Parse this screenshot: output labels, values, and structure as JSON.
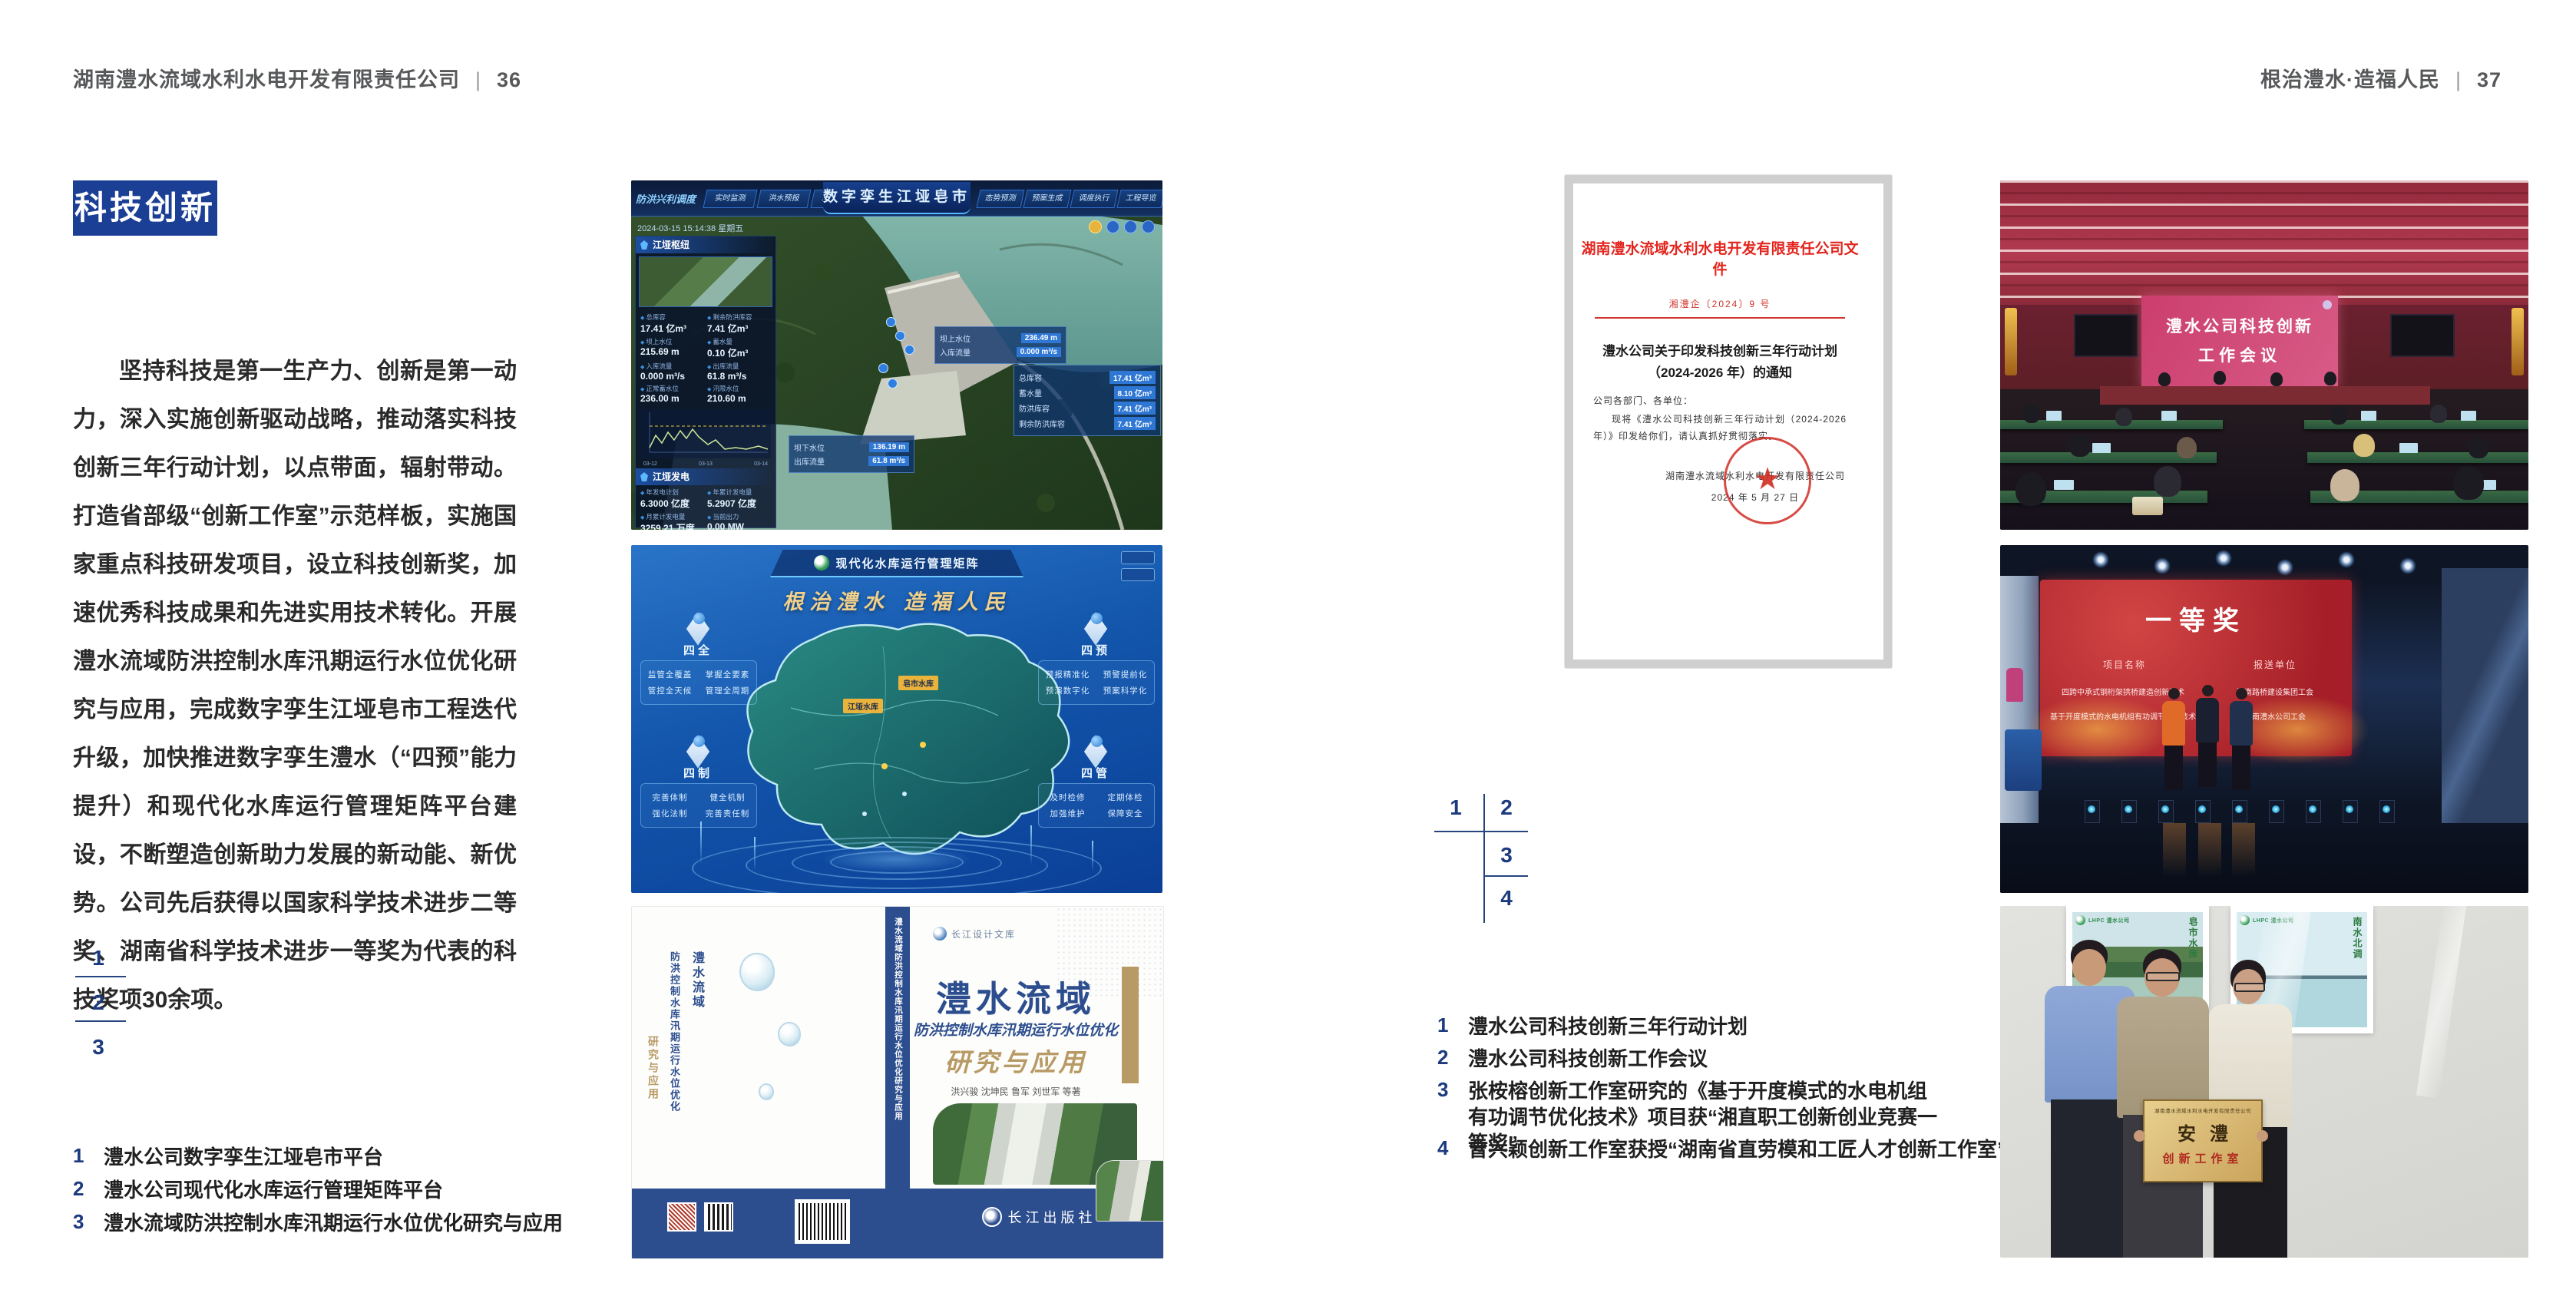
{
  "header_left": {
    "company": "湖南澧水流域水利水电开发有限责任公司",
    "sep": "|",
    "page": "36"
  },
  "header_right": {
    "slogan": "根治澧水·造福人民",
    "sep": "|",
    "page": "37"
  },
  "colors": {
    "accent_blue": "#1c3f96",
    "index_blue": "#1c3a7e",
    "doc_red": "#d0342c",
    "screen_pink": "#cb3e6e",
    "award_red": "#a61f28",
    "plaque_gold": "#caa45c"
  },
  "left_page": {
    "badge": "科技创新",
    "paragraph": "坚持科技是第一生产力、创新是第一动力，深入实施创新驱动战略，推动落实科技创新三年行动计划，以点带面，辐射带动。打造省部级“创新工作室”示范样板，实施国家重点科技研发项目，设立科技创新奖，加速优秀科技成果和先进实用技术转化。开展澧水流域防洪控制水库汛期运行水位优化研究与应用，完成数字孪生江垭皂市工程迭代升级，加快推进数字孪生澧水（“四预”能力提升）和现代化水库运行管理矩阵平台建设，不断塑造创新助力发展的新动能、新优势。公司先后获得以国家科学技术进步二等奖、湖南省科学技术进步一等奖为代表的科技奖项30余项。",
    "figure_index": {
      "n1": "1",
      "n2": "2",
      "n3": "3"
    },
    "captions": [
      {
        "num": "1",
        "text": "澧水公司数字孪生江垭皂市平台"
      },
      {
        "num": "2",
        "text": "澧水公司现代化水库运行管理矩阵平台"
      },
      {
        "num": "3",
        "text": "澧水流域防洪控制水库汛期运行水位优化研究与应用"
      }
    ]
  },
  "right_page": {
    "figure_index": {
      "n1": "1",
      "n2": "2",
      "n3": "3",
      "n4": "4"
    },
    "captions": [
      {
        "num": "1",
        "text": "澧水公司科技创新三年行动计划"
      },
      {
        "num": "2",
        "text": "澧水公司科技创新工作会议"
      },
      {
        "num": "3",
        "text": "张桉榕创新工作室研究的《基于开度模式的水电机组有功调节优化技术》项目获“湘直职工创新创业竞赛一等奖”"
      },
      {
        "num": "4",
        "text": "曾兴颖创新工作室获授“湖南省直劳模和工匠人才创新工作室”"
      }
    ]
  },
  "fig_twin": {
    "title": "数字孪生江垭皂市",
    "mode_label": "防洪兴利调度",
    "tabs_left": [
      "实时监测",
      "洪水预报",
      "防洪预警"
    ],
    "tabs_right": [
      "态势预测",
      "预案生成",
      "调度执行",
      "工程导览"
    ],
    "timestamp": "2024-03-15 15:14:38 星期五",
    "panel_hub": "江垭枢纽",
    "hub_stats": [
      [
        "总库容",
        "17.41 亿m³"
      ],
      [
        "剩余防洪库容",
        "7.41 亿m³"
      ],
      [
        "坝上水位",
        "215.69 m"
      ],
      [
        "蓄水量",
        "0.10 亿m³"
      ],
      [
        "入库流量",
        "0.000 m³/s"
      ],
      [
        "出库流量",
        "61.8 m³/s"
      ],
      [
        "正常蓄水位",
        "236.00 m"
      ],
      [
        "汛限水位",
        "210.60 m"
      ]
    ],
    "chart_xticks": [
      "03-12",
      "03-13",
      "03-14"
    ],
    "panel_gen": "江垭发电",
    "gen_stats": [
      [
        "年发电计划",
        "6.3000 亿度"
      ],
      [
        "年累计发电量",
        "5.2907 亿度"
      ],
      [
        "月累计发电量",
        "3259.21 万度"
      ],
      [
        "当前出力",
        "0.00 MW"
      ],
      [
        "发电流量",
        "0.00 m³/s"
      ],
      [
        "弃水流量",
        "0.00 m³/s"
      ]
    ],
    "callout_up": [
      [
        "坝上水位",
        "236.49 m"
      ],
      [
        "入库流量",
        "0.000 m³/s"
      ]
    ],
    "callout_cap": [
      [
        "总库容",
        "17.41 亿m³"
      ],
      [
        "蓄水量",
        "8.10 亿m³"
      ],
      [
        "防洪库容",
        "7.41 亿m³"
      ],
      [
        "剩余防洪库容",
        "7.41 亿m³"
      ]
    ],
    "callout_down": [
      [
        "坝下水位",
        "136.19 m"
      ],
      [
        "出库流量",
        "61.8 m³/s"
      ]
    ]
  },
  "fig_matrix": {
    "logo_text": "LHPC 澧水公司",
    "title": "现代化水库运行管理矩阵",
    "slogan": "根治澧水 造福人民",
    "corner_tl": {
      "title": "四全",
      "items": [
        "监管全覆盖",
        "掌握全要素",
        "管控全天候",
        "管理全周期"
      ]
    },
    "corner_tr": {
      "title": "四预",
      "items": [
        "预报精准化",
        "预警提前化",
        "预演数字化",
        "预案科学化"
      ]
    },
    "corner_bl": {
      "title": "四制",
      "items": [
        "完善体制",
        "健全机制",
        "强化法制",
        "完善责任制"
      ]
    },
    "corner_br": {
      "title": "四管",
      "items": [
        "及时检修",
        "定期体检",
        "加强维护",
        "保障安全"
      ]
    },
    "map_tags": [
      "皂市水库",
      "江垭水库"
    ]
  },
  "fig_book": {
    "series": "长江设计文库",
    "title_main": "澧水流域",
    "title_sub": "防洪控制水库汛期运行水位优化",
    "title_accent": "研究与应用",
    "authors": "洪兴骏  沈坤民  鲁军  刘世军  等著",
    "publisher": "长江出版社",
    "spine": "澧水流域防洪控制水库汛期运行水位优化研究与应用",
    "back_v1": "澧水流域",
    "back_v2": "防洪控制水库汛期运行水位优化",
    "back_v3": "研究与应用"
  },
  "fig_doc": {
    "header": "湖南澧水流域水利水电开发有限责任公司文件",
    "number": "湘澧企〔2024〕9 号",
    "title_line1": "澧水公司关于印发科技创新三年行动计划",
    "title_line2": "（2024-2026 年）的通知",
    "salutation": "公司各部门、各单位：",
    "body": "现将《澧水公司科技创新三年行动计划（2024-2026 年）》印发给你们，请认真抓好贯彻落实。",
    "signer": "湖南澧水流域水利水电开发有限责任公司",
    "date": "2024 年 5 月 27 日"
  },
  "fig_meeting": {
    "screen_line1": "澧水公司科技创新",
    "screen_line2": "工作会议"
  },
  "fig_award": {
    "title": "一等奖",
    "col_project": "项目名称",
    "col_org": "报送单位",
    "row1_project": "四跨中承式钢桁架拱桥建造创新技术",
    "row1_org": "湖南路桥建设集团工会",
    "row2_project": "基于开度模式的水电机组有功调节优化技术",
    "row2_org": "湖南澧水公司工会"
  },
  "fig_plaque": {
    "poster_logo": "LHPC 澧水公司",
    "poster_left_title": "皂市水库",
    "poster_right_title": "南水北调",
    "plaque_header": "湖南澧水流域水利水电开发有限责任公司",
    "plaque_main": "安澧",
    "plaque_sub": "创新工作室"
  }
}
